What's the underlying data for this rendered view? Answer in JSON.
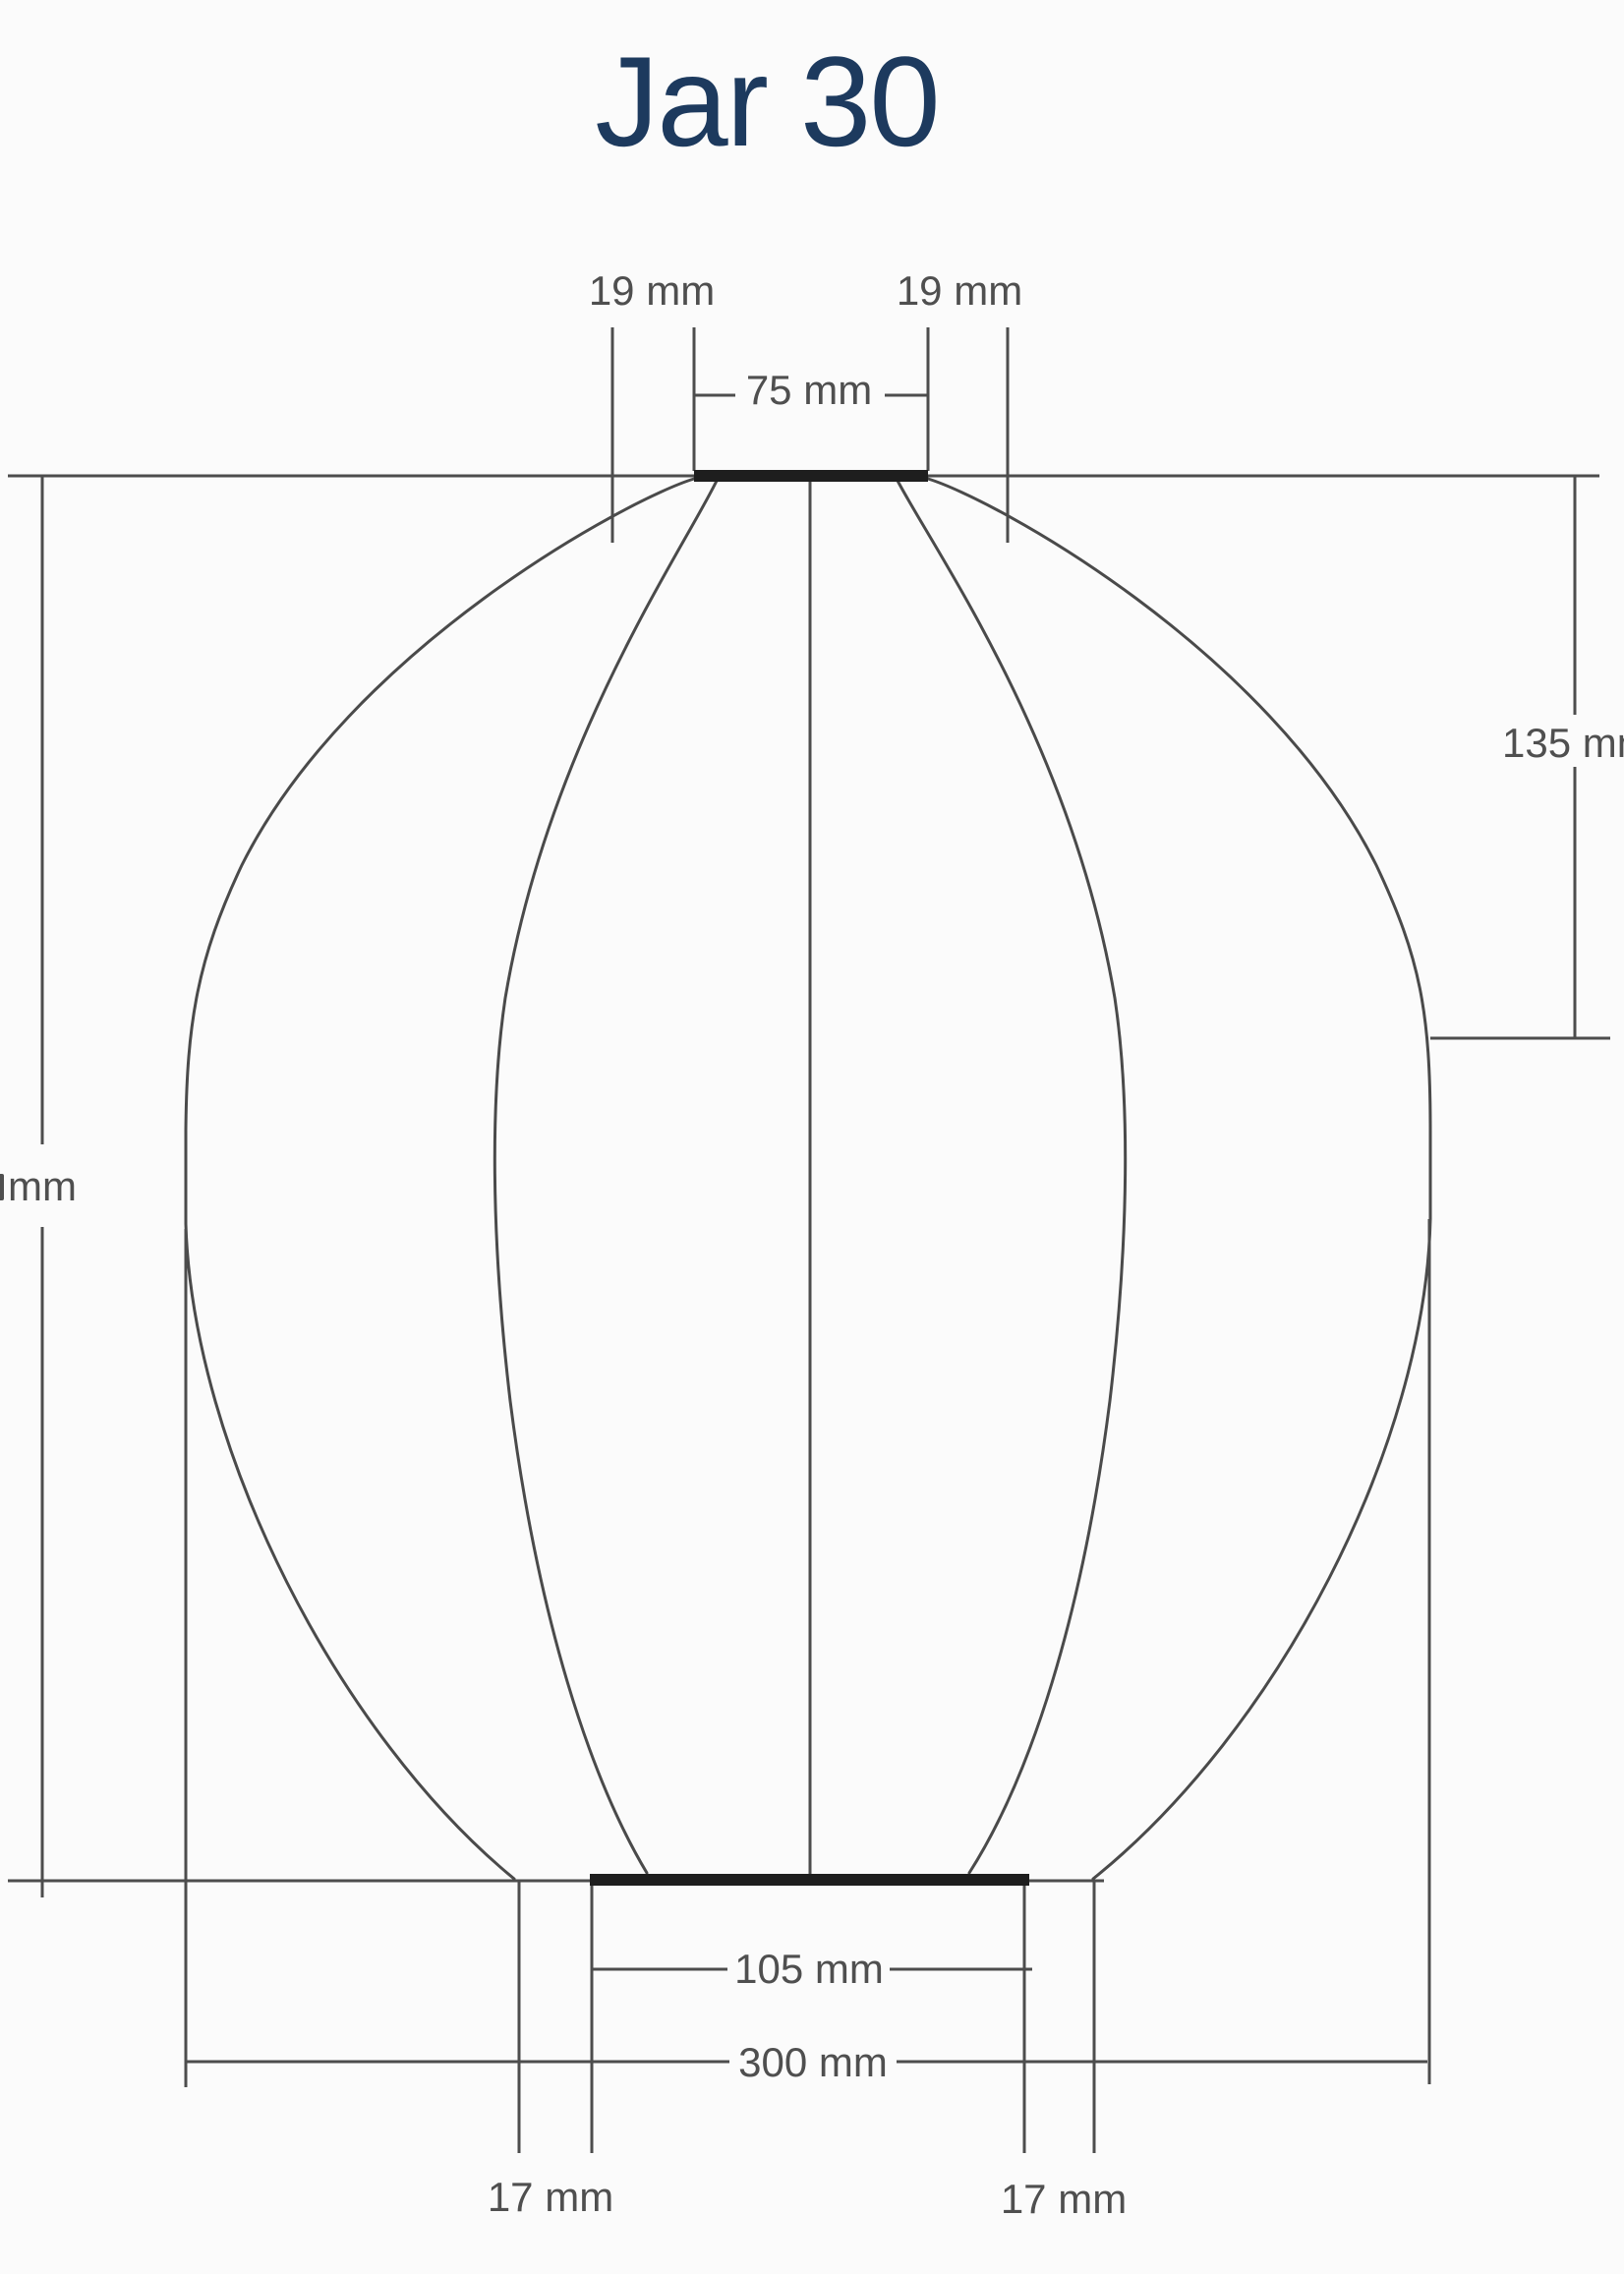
{
  "title": "Jar 30",
  "colors": {
    "title_text": "#1d3a5e",
    "dimension_lines": "#4d4d4d",
    "dimension_text": "#4f4f4f",
    "solid_rim_bars": "#1e1e1e",
    "background": "#fbfbfb"
  },
  "diagram": {
    "type": "technical-dimension-drawing",
    "subject": "jar-shaped lantern profile with ribs, top opening and flat base",
    "labels": {
      "neck_offset_left": "19 mm",
      "neck_offset_right": "19 mm",
      "neck_width": "75 mm",
      "neck_to_shoulder_height": "135 mm",
      "overall_height_clipped": "mm",
      "base_width": "105 mm",
      "overall_width": "300 mm",
      "base_inset_left": "17 mm",
      "base_inset_right": "17 mm"
    }
  }
}
